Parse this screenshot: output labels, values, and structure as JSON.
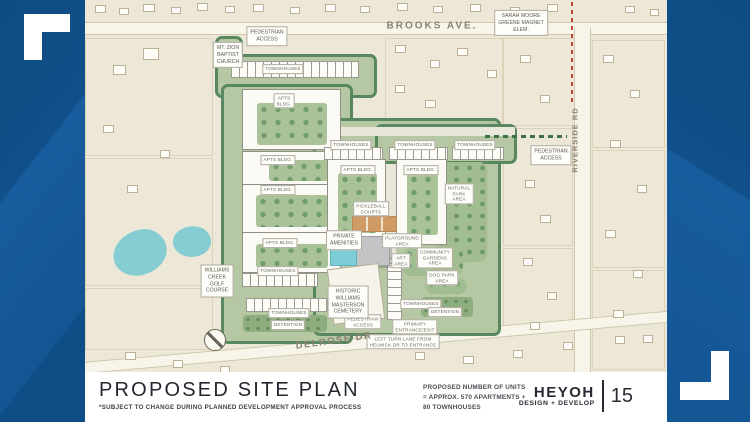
{
  "palette": {
    "brand_blue": "#11528e",
    "map_beige": "#ece7d7",
    "site_green": "#b5c7a3",
    "tree_green": "#598760",
    "water_teal": "#85ccd3",
    "court_orange": "#cf9a63",
    "school_zone_red": "#c04438",
    "ink": "#23272f"
  },
  "footer": {
    "title": "PROPOSED SITE PLAN",
    "subtitle": "*SUBJECT TO CHANGE DURING PLANNED DEVELOPMENT APPROVAL PROCESS",
    "units_note_lines": [
      "PROPOSED NUMBER OF UNITS",
      "= APPROX. 570 APARTMENTS +",
      "80 TOWNHOUSES"
    ],
    "firm_name": "HEYOH",
    "firm_tagline": "DESIGN + DEVELOP",
    "page_number": "15"
  },
  "map": {
    "elements": [
      {
        "id": "brooks-ave-road",
        "t": "road",
        "x": 0,
        "y": 22,
        "w": 582,
        "h": 13
      },
      {
        "id": "riverside-rd-road",
        "t": "road-v",
        "x": 489,
        "y": 28,
        "w": 17,
        "h": 344
      },
      {
        "id": "delrose-dr-road",
        "t": "road",
        "x": -20,
        "y": 336,
        "w": 630,
        "h": 12,
        "rot": -5
      },
      {
        "id": "school-zone-dashed-line",
        "t": "dash-v-red",
        "x": 486,
        "y": 2,
        "w": 2,
        "h": 100
      },
      {
        "id": "pedestrian-path-east",
        "t": "dash-h-green",
        "x": 400,
        "y": 135,
        "w": 82,
        "h": 3
      },
      {
        "id": "golf-pond-west",
        "t": "pond",
        "x": 28,
        "y": 230,
        "w": 54,
        "h": 45,
        "rot": -12
      },
      {
        "id": "golf-pond-east",
        "t": "pond",
        "x": 88,
        "y": 226,
        "w": 38,
        "h": 31,
        "rot": 8
      },
      {
        "id": "site-access-north",
        "t": "area",
        "x": 130,
        "y": 36,
        "w": 28,
        "h": 60
      },
      {
        "id": "site-north-townhouses",
        "t": "area",
        "x": 130,
        "y": 54,
        "w": 162,
        "h": 44
      },
      {
        "id": "site-west",
        "t": "area",
        "x": 136,
        "y": 84,
        "w": 132,
        "h": 260
      },
      {
        "id": "site-central",
        "t": "area",
        "x": 228,
        "y": 118,
        "w": 188,
        "h": 218
      },
      {
        "id": "site-east-townhouses",
        "t": "area",
        "x": 290,
        "y": 124,
        "w": 142,
        "h": 40
      },
      {
        "id": "drive-central",
        "t": "path",
        "x": 301,
        "y": 164,
        "w": 10,
        "h": 100
      },
      {
        "id": "drive-crosstown",
        "t": "path",
        "x": 236,
        "y": 127,
        "w": 194,
        "h": 9
      },
      {
        "id": "natural-park-area",
        "t": "green-patch",
        "x": 352,
        "y": 162,
        "w": 50,
        "h": 100
      },
      {
        "id": "community-gardens-area",
        "t": "green-patch",
        "x": 318,
        "y": 248,
        "w": 60,
        "h": 28
      },
      {
        "id": "dog-park-area",
        "t": "green-patch",
        "x": 340,
        "y": 278,
        "w": 42,
        "h": 16
      },
      {
        "id": "detention-basin-sw",
        "t": "green-dark",
        "x": 158,
        "y": 315,
        "w": 84,
        "h": 17
      },
      {
        "id": "detention-basin-se",
        "t": "green-dark",
        "x": 336,
        "y": 297,
        "w": 52,
        "h": 20
      },
      {
        "id": "apts-bldg-nw",
        "t": "bldg",
        "x": 157,
        "y": 89,
        "w": 99,
        "h": 61,
        "court": {
          "x": 14,
          "y": 13,
          "w": 70,
          "h": 42
        }
      },
      {
        "id": "apts-bldg-w2",
        "t": "bldg",
        "x": 157,
        "y": 151,
        "w": 99,
        "h": 35,
        "court": {
          "x": 26,
          "y": 8,
          "w": 62,
          "h": 21
        }
      },
      {
        "id": "apts-bldg-w3",
        "t": "bldg",
        "x": 157,
        "y": 184,
        "w": 99,
        "h": 49,
        "court": {
          "x": 13,
          "y": 10,
          "w": 72,
          "h": 32
        }
      },
      {
        "id": "apts-bldg-sw",
        "t": "bldg",
        "x": 157,
        "y": 232,
        "w": 99,
        "h": 41,
        "court": {
          "x": 13,
          "y": 11,
          "w": 72,
          "h": 24
        }
      },
      {
        "id": "apts-bldg-central",
        "t": "bldg",
        "x": 242,
        "y": 159,
        "w": 59,
        "h": 84,
        "court": {
          "x": 10,
          "y": 13,
          "w": 39,
          "h": 60
        }
      },
      {
        "id": "apts-bldg-east",
        "t": "bldg",
        "x": 311,
        "y": 159,
        "w": 51,
        "h": 86,
        "court": {
          "x": 10,
          "y": 13,
          "w": 31,
          "h": 62
        }
      },
      {
        "id": "townhouses-north-row",
        "t": "units-h",
        "x": 146,
        "y": 61,
        "w": 128,
        "h": 17
      },
      {
        "id": "townhouses-ne-row-1",
        "t": "units-h",
        "x": 239,
        "y": 147,
        "w": 59,
        "h": 13
      },
      {
        "id": "townhouses-ne-row-2",
        "t": "units-h",
        "x": 304,
        "y": 147,
        "w": 59,
        "h": 13
      },
      {
        "id": "townhouses-ne-row-3",
        "t": "units-h",
        "x": 367,
        "y": 147,
        "w": 52,
        "h": 13
      },
      {
        "id": "townhouses-sw-row-1",
        "t": "units-h",
        "x": 157,
        "y": 273,
        "w": 76,
        "h": 14
      },
      {
        "id": "townhouses-sw-row-2",
        "t": "units-h",
        "x": 161,
        "y": 298,
        "w": 82,
        "h": 14
      },
      {
        "id": "townhouses-s-vertical",
        "t": "units-v",
        "x": 302,
        "y": 258,
        "w": 15,
        "h": 62
      },
      {
        "id": "pickleball-courts",
        "t": "courts",
        "x": 267,
        "y": 216,
        "w": 45,
        "h": 16
      },
      {
        "id": "clubhouse-building",
        "t": "gray-bldg",
        "x": 271,
        "y": 236,
        "w": 34,
        "h": 30
      },
      {
        "id": "pool",
        "t": "pool",
        "x": 245,
        "y": 246,
        "w": 27,
        "h": 20
      },
      {
        "id": "cemetery-plot",
        "t": "plot",
        "x": 245,
        "y": 266,
        "w": 52,
        "h": 56,
        "rot": -7
      },
      {
        "id": "north-compass",
        "t": "compass",
        "x": 130,
        "y": 340,
        "w": 22,
        "h": 22
      },
      {
        "id": "label-ped-access-north",
        "t": "card",
        "x": 182,
        "y": 36,
        "lines": [
          "PEDESTRIAN",
          "ACCESS"
        ]
      },
      {
        "id": "label-townhouses-north",
        "t": "chip",
        "x": 198,
        "y": 69,
        "lines": [
          "TOWNHOUSES"
        ]
      },
      {
        "id": "label-apts-nw",
        "t": "chip",
        "x": 199,
        "y": 101,
        "lines": [
          "APTS",
          "BLDG."
        ]
      },
      {
        "id": "label-apts-w2",
        "t": "chip",
        "x": 193,
        "y": 160,
        "lines": [
          "APTS BLDG."
        ]
      },
      {
        "id": "label-apts-w3",
        "t": "chip",
        "x": 193,
        "y": 190,
        "lines": [
          "APTS BLDG."
        ]
      },
      {
        "id": "label-apts-sw",
        "t": "chip",
        "x": 195,
        "y": 243,
        "lines": [
          "APTS BLDG."
        ]
      },
      {
        "id": "label-apts-central",
        "t": "chip",
        "x": 273,
        "y": 170,
        "lines": [
          "APTS BLDG."
        ]
      },
      {
        "id": "label-apts-east",
        "t": "chip",
        "x": 336,
        "y": 170,
        "lines": [
          "APTS BLDG."
        ]
      },
      {
        "id": "label-townhouses-ne-1",
        "t": "chip",
        "x": 266,
        "y": 145,
        "lines": [
          "TOWNHOUSES"
        ]
      },
      {
        "id": "label-townhouses-ne-2",
        "t": "chip",
        "x": 330,
        "y": 145,
        "lines": [
          "TOWNHOUSES"
        ]
      },
      {
        "id": "label-townhouses-ne-3",
        "t": "chip",
        "x": 390,
        "y": 145,
        "lines": [
          "TOWNHOUSES"
        ]
      },
      {
        "id": "label-natural-park",
        "t": "chip",
        "x": 374,
        "y": 194,
        "lines": [
          "NATURAL",
          "PARK",
          "AREA"
        ]
      },
      {
        "id": "label-pickleball",
        "t": "chip",
        "x": 286,
        "y": 209,
        "lines": [
          "PICKLEBALL",
          "COURTS"
        ]
      },
      {
        "id": "label-private-amenities",
        "t": "card",
        "x": 259,
        "y": 240,
        "lines": [
          "PRIVATE",
          "AMENITIES"
        ]
      },
      {
        "id": "label-playground",
        "t": "chip",
        "x": 317,
        "y": 241,
        "lines": [
          "PLAYGROUND",
          "AREA"
        ]
      },
      {
        "id": "label-art-area",
        "t": "chip",
        "x": 316,
        "y": 261,
        "lines": [
          "ART",
          "AREA"
        ]
      },
      {
        "id": "label-community-gardens",
        "t": "chip",
        "x": 350,
        "y": 258,
        "lines": [
          "COMMUNITY",
          "GARDENS",
          "AREA"
        ]
      },
      {
        "id": "label-dog-park",
        "t": "chip",
        "x": 357,
        "y": 278,
        "lines": [
          "DOG PARK",
          "AREA"
        ]
      },
      {
        "id": "label-townhouses-sw-1",
        "t": "chip",
        "x": 193,
        "y": 271,
        "lines": [
          "TOWNHOUSES"
        ]
      },
      {
        "id": "label-townhouses-sw-2",
        "t": "chip",
        "x": 204,
        "y": 313,
        "lines": [
          "TOWNHOUSES"
        ]
      },
      {
        "id": "label-detention-sw",
        "t": "chip",
        "x": 203,
        "y": 325,
        "lines": [
          "DETENTION"
        ]
      },
      {
        "id": "label-townhouses-se",
        "t": "chip",
        "x": 336,
        "y": 304,
        "lines": [
          "TOWNHOUSES"
        ]
      },
      {
        "id": "label-detention-se",
        "t": "chip",
        "x": 360,
        "y": 312,
        "lines": [
          "DETENTION"
        ]
      },
      {
        "id": "label-cemetery",
        "t": "card",
        "x": 263,
        "y": 302,
        "lines": [
          "HISTORIC",
          "WILLIAMS",
          "MASTERSON",
          "CEMETERY"
        ]
      },
      {
        "id": "label-ped-access-south",
        "t": "chip",
        "x": 278,
        "y": 322,
        "lines": [
          "PEDESTRIAN",
          "ACCESS"
        ]
      },
      {
        "id": "label-primary-entrance",
        "t": "chip",
        "x": 330,
        "y": 327,
        "lines": [
          "PRIMARY",
          "ENTRANCE/EXIT"
        ]
      },
      {
        "id": "label-left-turn-lane",
        "t": "chip",
        "x": 318,
        "y": 342,
        "lines": [
          "LEFT TURN LANE FROM",
          "HELMICK DR TO ENTRANCE"
        ]
      },
      {
        "id": "label-ped-access-east",
        "t": "card",
        "x": 466,
        "y": 155,
        "lines": [
          "PEDESTRIAN",
          "ACCESS"
        ]
      },
      {
        "id": "label-mt-zion-church",
        "t": "card",
        "x": 143,
        "y": 55,
        "lines": [
          "MT. ZION",
          "BAPTIST",
          "CHURCH"
        ]
      },
      {
        "id": "label-sarah-moore-school",
        "t": "card",
        "x": 436,
        "y": 23,
        "lines": [
          "SARAH MOORE",
          "GREENE MAGNET",
          "ELEM."
        ]
      },
      {
        "id": "label-golf-course",
        "t": "card",
        "x": 132,
        "y": 281,
        "lines": [
          "WILLIAMS",
          "CREEK",
          "GOLF",
          "COURSE"
        ]
      },
      {
        "id": "street-brooks-ave",
        "t": "street",
        "x": 347,
        "y": 26,
        "text": "BROOKS AVE.",
        "size": 10,
        "ls": 2
      },
      {
        "id": "street-riverside-rd",
        "t": "street-v",
        "x": 490,
        "y": 140,
        "text": "RIVERSIDE RD",
        "size": 7.5,
        "ls": 1
      },
      {
        "id": "street-delrose-dr",
        "t": "street",
        "x": 249,
        "y": 341,
        "text": "DELROSE DR",
        "size": 9.5,
        "ls": 1.5,
        "rot": -8
      }
    ],
    "parcels": [
      [
        0,
        38,
        128,
        118
      ],
      [
        0,
        158,
        128,
        128
      ],
      [
        0,
        288,
        128,
        62
      ],
      [
        300,
        38,
        118,
        85
      ],
      [
        418,
        38,
        72,
        88
      ],
      [
        418,
        128,
        70,
        118
      ],
      [
        418,
        248,
        70,
        80
      ],
      [
        507,
        40,
        73,
        108
      ],
      [
        507,
        150,
        73,
        118
      ],
      [
        507,
        270,
        73,
        100
      ]
    ],
    "houses": [
      [
        10,
        5,
        11,
        8
      ],
      [
        34,
        8,
        10,
        7
      ],
      [
        58,
        4,
        12,
        8
      ],
      [
        86,
        7,
        10,
        7
      ],
      [
        112,
        3,
        11,
        8
      ],
      [
        140,
        6,
        10,
        7
      ],
      [
        168,
        4,
        11,
        8
      ],
      [
        205,
        7,
        10,
        7
      ],
      [
        240,
        4,
        11,
        8
      ],
      [
        275,
        6,
        10,
        7
      ],
      [
        312,
        3,
        11,
        8
      ],
      [
        348,
        6,
        10,
        7
      ],
      [
        385,
        4,
        11,
        8
      ],
      [
        425,
        7,
        10,
        7
      ],
      [
        462,
        4,
        11,
        8
      ],
      [
        540,
        6,
        10,
        7
      ],
      [
        565,
        9,
        9,
        7
      ],
      [
        310,
        45,
        11,
        8
      ],
      [
        345,
        60,
        10,
        8
      ],
      [
        372,
        48,
        11,
        8
      ],
      [
        402,
        70,
        10,
        8
      ],
      [
        435,
        55,
        11,
        8
      ],
      [
        455,
        95,
        10,
        8
      ],
      [
        310,
        85,
        10,
        8
      ],
      [
        340,
        100,
        11,
        8
      ],
      [
        440,
        180,
        10,
        8
      ],
      [
        455,
        215,
        11,
        8
      ],
      [
        438,
        258,
        10,
        8
      ],
      [
        462,
        292,
        10,
        8
      ],
      [
        445,
        322,
        10,
        8
      ],
      [
        518,
        55,
        11,
        8
      ],
      [
        545,
        90,
        10,
        8
      ],
      [
        525,
        140,
        11,
        8
      ],
      [
        552,
        185,
        10,
        8
      ],
      [
        520,
        230,
        11,
        8
      ],
      [
        548,
        270,
        10,
        8
      ],
      [
        528,
        310,
        11,
        8
      ],
      [
        558,
        335,
        10,
        8
      ],
      [
        28,
        65,
        13,
        10
      ],
      [
        58,
        48,
        16,
        12
      ],
      [
        18,
        125,
        11,
        8
      ],
      [
        75,
        150,
        10,
        8
      ],
      [
        42,
        185,
        11,
        8
      ],
      [
        40,
        352,
        11,
        8
      ],
      [
        88,
        360,
        10,
        8
      ],
      [
        135,
        366,
        10,
        7
      ],
      [
        330,
        352,
        10,
        8
      ],
      [
        378,
        356,
        11,
        8
      ],
      [
        428,
        350,
        10,
        8
      ],
      [
        478,
        342,
        10,
        8
      ],
      [
        530,
        336,
        10,
        8
      ]
    ]
  }
}
